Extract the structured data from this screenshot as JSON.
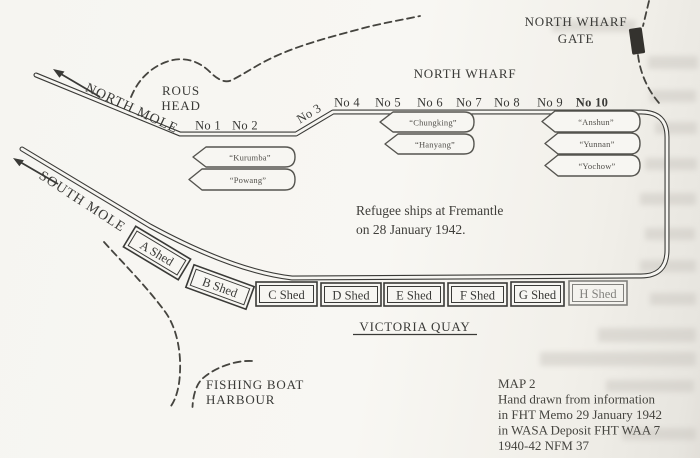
{
  "page": {
    "labels": {
      "north_wharf": "NORTH WHARF",
      "gate_line1": "NORTH WHARF",
      "gate_line2": "GATE",
      "rous_line1": "ROUS",
      "rous_line2": "HEAD",
      "north_mole": "NORTH MOLE",
      "south_mole": "SOUTH MOLE",
      "victoria_quay": "VICTORIA QUAY",
      "fishing_line1": "FISHING BOAT",
      "fishing_line2": "HARBOUR"
    },
    "note": {
      "line1": "Refugee ships at Fremantle",
      "line2": "on 28 January 1942."
    },
    "berths": [
      "No 1",
      "No 2",
      "No 3",
      "No 4",
      "No 5",
      "No 6",
      "No 7",
      "No 8",
      "No 9",
      "No 10"
    ],
    "ships": [
      "“Kurumba”",
      "“Powang”",
      "“Chungking”",
      "“Hanyang”",
      "“Anshun”",
      "“Yunnan”",
      "“Yochow”"
    ],
    "sheds": [
      "A Shed",
      "B Shed",
      "C Shed",
      "D Shed",
      "E Shed",
      "F Shed",
      "G Shed",
      "H Shed"
    ],
    "caption": [
      "MAP 2",
      "Hand drawn from information",
      "in FHT Memo 29 January 1942",
      "in WASA Deposit FHT WAA 7",
      "1940-42 NFM 37"
    ],
    "colors": {
      "ink": "#3a3a37",
      "paper": "#f7f6f2"
    }
  }
}
